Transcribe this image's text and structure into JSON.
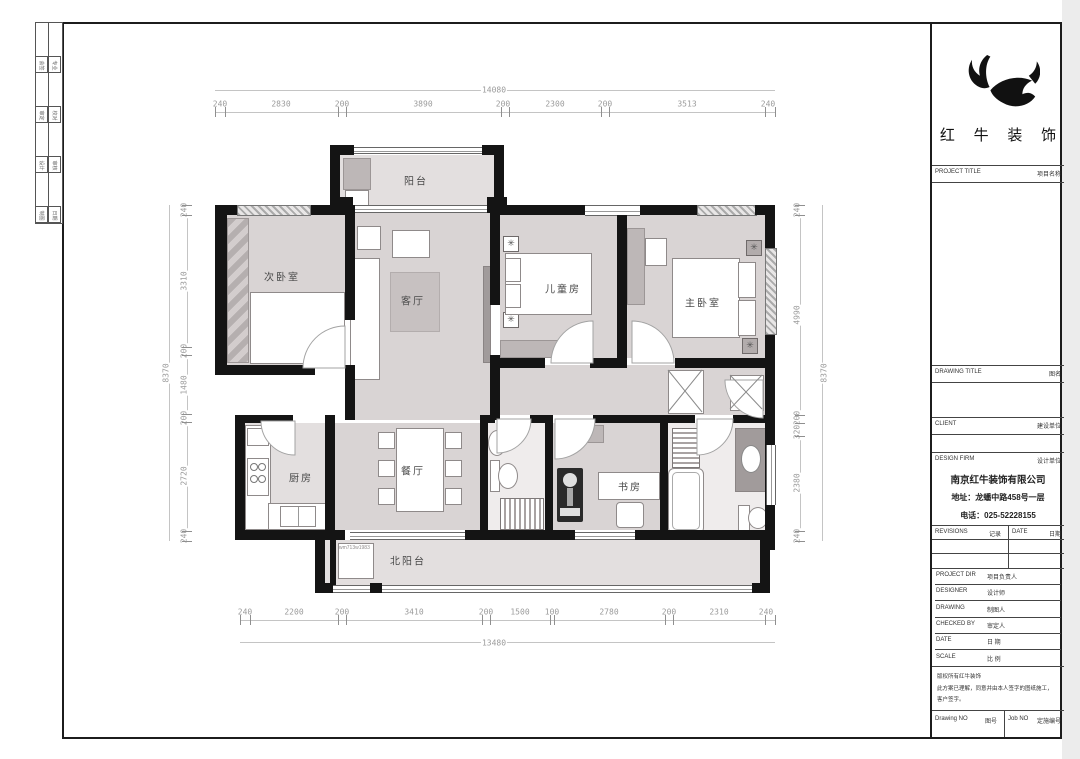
{
  "brand": {
    "company_cn": "红 牛 装 饰"
  },
  "titleblock": {
    "project_title_en": "PROJECT TITLE",
    "project_title_cn": "项目名称",
    "drawing_title_en": "DRAWING TITLE",
    "drawing_title_cn": "图名",
    "client_en": "CLIENT",
    "client_cn": "建设单位",
    "design_firm_en": "DESIGN FIRM",
    "design_firm_cn": "设计单位",
    "company_name": "南京红牛装饰有限公司",
    "company_address": "地址：龙蟠中路458号一层",
    "company_phone": "电话：025-52228155",
    "revisions_en": "REVISIONS",
    "revisions_cn": "记录",
    "date_hdr_en": "DATE",
    "date_hdr_cn": "日期",
    "rows": [
      {
        "en": "PROJECT DIR",
        "cn": "项目负责人"
      },
      {
        "en": "DESIGNER",
        "cn": "设计师"
      },
      {
        "en": "DRAWING",
        "cn": "制图人"
      },
      {
        "en": "CHECKED BY",
        "cn": "审定人"
      },
      {
        "en": "DATE",
        "cn": "日 期"
      },
      {
        "en": "SCALE",
        "cn": "比 例"
      }
    ],
    "disclaimer": [
      "版权所有红牛装饰",
      "此方案已理解，同意并由本人签字的图纸施工，",
      "客户签字。"
    ],
    "drawing_no_en": "Drawing NO",
    "drawing_no_cn": "图号",
    "job_no_en": "Job NO",
    "job_no_cn": "定施编号"
  },
  "strip": {
    "labels": [
      "会签",
      "专业",
      "审定",
      "校对",
      "设计",
      "审核",
      "制图",
      "日期"
    ]
  },
  "plan": {
    "rooms": [
      {
        "key": "balcony",
        "label": "阳台"
      },
      {
        "key": "secondary-bedroom",
        "label": "次卧室"
      },
      {
        "key": "living-room",
        "label": "客厅"
      },
      {
        "key": "children-room",
        "label": "儿童房"
      },
      {
        "key": "master-bedroom",
        "label": "主卧室"
      },
      {
        "key": "kitchen",
        "label": "厨房"
      },
      {
        "key": "dining-room",
        "label": "餐厅"
      },
      {
        "key": "study",
        "label": "书房"
      },
      {
        "key": "north-balcony",
        "label": "北阳台"
      }
    ],
    "washer_note": "wm713w1983"
  },
  "dims": {
    "top_total": "14080",
    "top": [
      "240",
      "2830",
      "200",
      "3890",
      "200",
      "2300",
      "200",
      "3513",
      "240"
    ],
    "bottom": [
      "240",
      "2200",
      "200",
      "3410",
      "200",
      "1500",
      "100",
      "2780",
      "200",
      "2310",
      "240"
    ],
    "bottom_total": "13480",
    "left_total": "8370",
    "left": [
      "240",
      "3310",
      "200",
      "1480",
      "200",
      "2720",
      "240"
    ],
    "right": [
      "240",
      "4990",
      "200",
      "320",
      "2380",
      "240"
    ],
    "right_total": "8370"
  }
}
